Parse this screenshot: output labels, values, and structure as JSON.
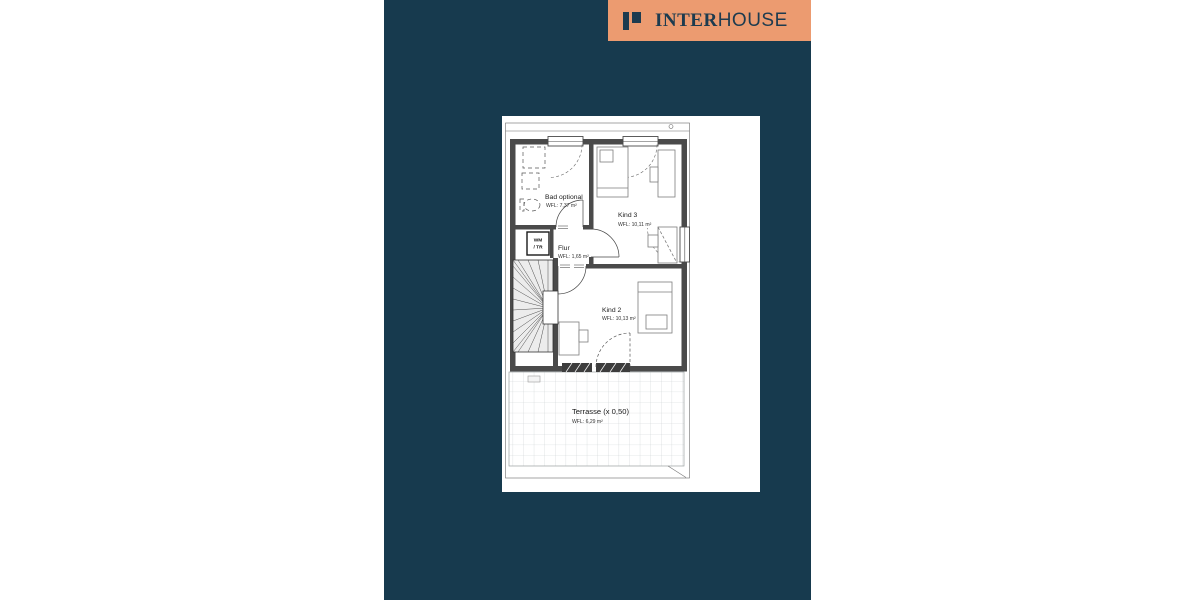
{
  "logo": {
    "brand_part1": "INTER",
    "brand_part2": "HOUSE"
  },
  "plan": {
    "rooms": [
      {
        "name": "Bad optional",
        "area": "WFL: 7,37 m²"
      },
      {
        "name": "Kind 3",
        "area": "WFL: 10,11 m²"
      },
      {
        "name": "Flur",
        "area": "WFL: 1,65 m²"
      },
      {
        "name": "Kind 2",
        "area": "WFL: 10,13 m²"
      },
      {
        "name": "Terrasse (x 0,50)",
        "area": "WFL: 6,29 m²"
      }
    ],
    "closet": {
      "line1": "WM",
      "line2": "/ TR"
    }
  },
  "colors": {
    "brand_panel": "#173A4E",
    "logo_background": "#EC9B70",
    "logo_text": "#1D3B4F",
    "wall": "#4A4A4A",
    "paper": "#FFFFFF"
  }
}
